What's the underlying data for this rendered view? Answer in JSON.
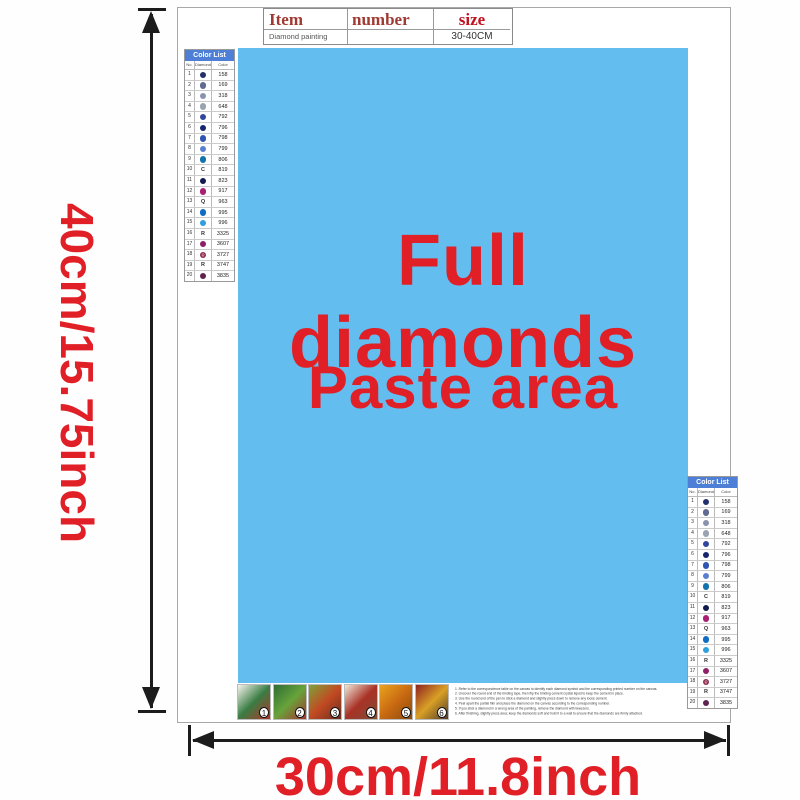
{
  "colors": {
    "accent_red": "#e01f26",
    "header_dark_red": "#a03a32",
    "size_red": "#c1121f",
    "paste_blue": "#63bdee",
    "arrow_black": "#1c1c1c",
    "color_list_header_bg": "#4d7fd6"
  },
  "info_table": {
    "headers": [
      "Item",
      "number",
      "size"
    ],
    "row": {
      "item": "Diamond painting",
      "number": "",
      "size": "30-40CM"
    }
  },
  "paste_area": {
    "line1": "Full diamonds",
    "line2": "Paste area"
  },
  "dimensions": {
    "height_label": "40cm/15.75inch",
    "width_label": "30cm/11.8inch"
  },
  "color_list": {
    "title": "Color List",
    "columns": [
      "No.",
      "Diamond",
      "Color"
    ],
    "rows": [
      {
        "no": "1",
        "code": "158",
        "filled": true,
        "symbol": "",
        "color": "#23306e"
      },
      {
        "no": "2",
        "code": "169",
        "filled": true,
        "symbol": "",
        "color": "#5f6b8f"
      },
      {
        "no": "3",
        "code": "318",
        "filled": true,
        "symbol": "",
        "color": "#8a93ad"
      },
      {
        "no": "4",
        "code": "648",
        "filled": true,
        "symbol": "",
        "color": "#9aa3b0"
      },
      {
        "no": "5",
        "code": "792",
        "filled": true,
        "symbol": "",
        "color": "#31479e"
      },
      {
        "no": "6",
        "code": "796",
        "filled": true,
        "symbol": "",
        "color": "#17256e"
      },
      {
        "no": "7",
        "code": "798",
        "filled": true,
        "symbol": "",
        "color": "#2e56b0"
      },
      {
        "no": "8",
        "code": "799",
        "filled": true,
        "symbol": "",
        "color": "#5b7fd0"
      },
      {
        "no": "9",
        "code": "806",
        "filled": true,
        "symbol": "",
        "color": "#1273ae"
      },
      {
        "no": "10",
        "code": "819",
        "filled": false,
        "symbol": "C",
        "color": "#333333"
      },
      {
        "no": "11",
        "code": "823",
        "filled": true,
        "symbol": "",
        "color": "#101c4e"
      },
      {
        "no": "12",
        "code": "917",
        "filled": true,
        "symbol": "",
        "color": "#a91f74"
      },
      {
        "no": "13",
        "code": "963",
        "filled": false,
        "symbol": "Q",
        "color": "#333333"
      },
      {
        "no": "14",
        "code": "995",
        "filled": true,
        "symbol": "",
        "color": "#0f6ec4"
      },
      {
        "no": "15",
        "code": "996",
        "filled": true,
        "symbol": "",
        "color": "#2f9fdd"
      },
      {
        "no": "16",
        "code": "3325",
        "filled": false,
        "symbol": "R",
        "color": "#333333"
      },
      {
        "no": "17",
        "code": "3607",
        "filled": true,
        "symbol": "",
        "color": "#8e2068"
      },
      {
        "no": "18",
        "code": "3727",
        "filled": true,
        "symbol": "Q",
        "color": "#8f2f4f"
      },
      {
        "no": "19",
        "code": "3747",
        "filled": false,
        "symbol": "R",
        "color": "#333333"
      },
      {
        "no": "20",
        "code": "3835",
        "filled": true,
        "symbol": "",
        "color": "#5f2350"
      }
    ]
  },
  "bottom_strip": {
    "thumbnails": [
      {
        "num": "1",
        "gradient": [
          "#f7f4ee",
          "#3a7d44",
          "#b3342a"
        ]
      },
      {
        "num": "2",
        "gradient": [
          "#2f6d35",
          "#67a33b",
          "#a8352c"
        ]
      },
      {
        "num": "3",
        "gradient": [
          "#7fa23a",
          "#c24a22",
          "#6b2d20"
        ]
      },
      {
        "num": "4",
        "gradient": [
          "#efe8da",
          "#a93226",
          "#7d4e35"
        ]
      },
      {
        "num": "5",
        "gradient": [
          "#e9a31f",
          "#c96a12",
          "#8a4a0e"
        ]
      },
      {
        "num": "6",
        "gradient": [
          "#8f2320",
          "#d9a025",
          "#4f3a2c"
        ]
      }
    ],
    "instructions": [
      "1. Refer to the correspondence table on the canvas to identify each diamond symbol and the corresponding printed number on the canvas.",
      "2. Uncover the round end of the binding tape, then flip the binding cement crystal liquid to keep the cement in place.",
      "3. Use the round end of the pen to stick a diamond and slightly press down to remove any loose cement.",
      "4. Peel apart the partial film and place the diamond on the canvas according to the corresponding number.",
      "5. If you stick a diamond in a wrong area of the painting, remove the diamond with tweezers.",
      "6. After finishing, slightly press area; keep the diamonds soft and hold it to a wall to ensure that the diamonds are firmly attached."
    ]
  }
}
